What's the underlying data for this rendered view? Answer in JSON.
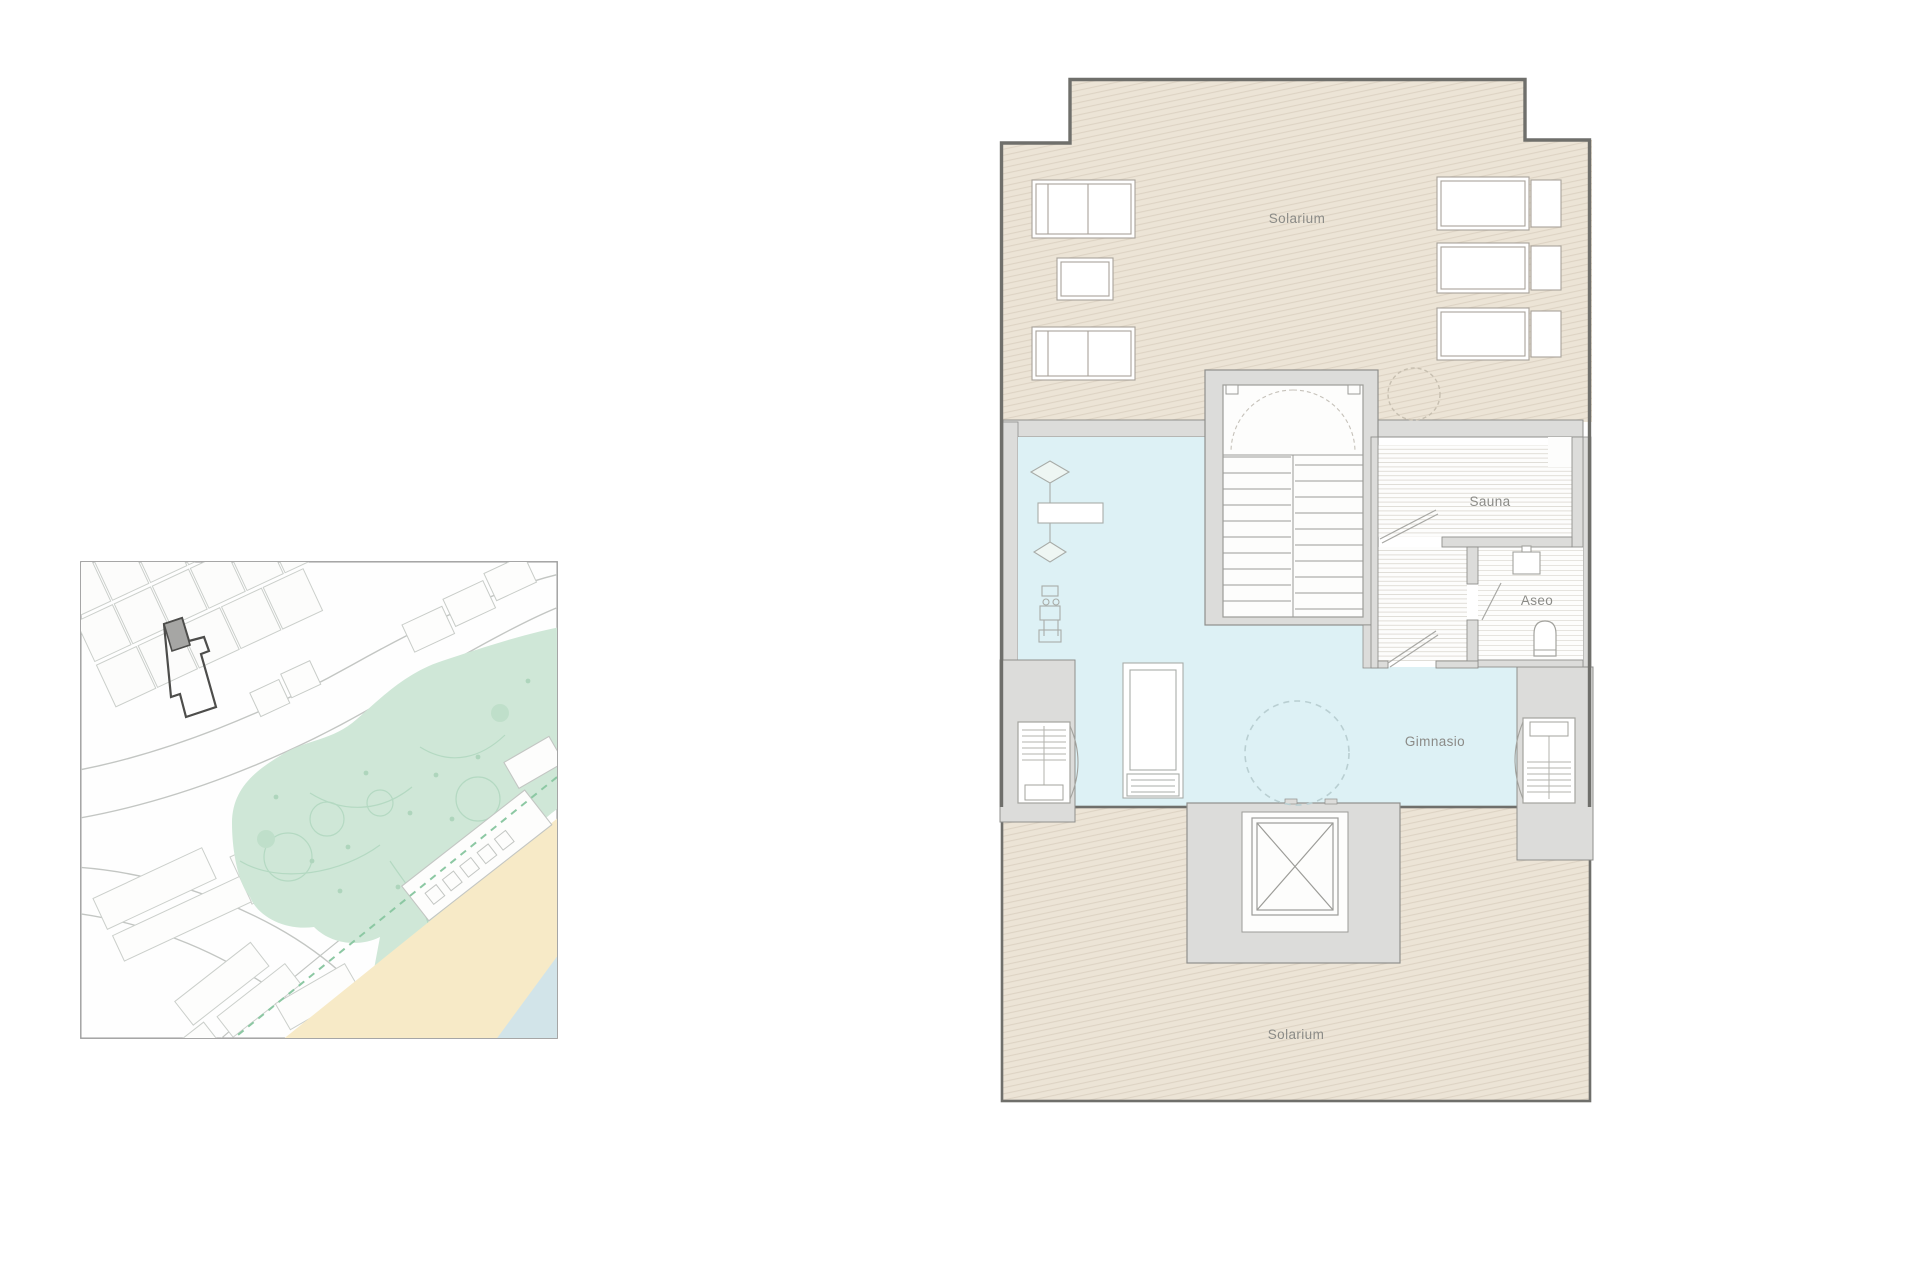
{
  "page": {
    "background": "#ffffff"
  },
  "floor_plan": {
    "rooms": {
      "solarium_top": "Solarium",
      "sauna": "Sauna",
      "aseo": "Aseo",
      "gimnasio": "Gimnasio",
      "solarium_bottom": "Solarium"
    },
    "colors": {
      "solarium_floor": "#ece4d6",
      "solarium_hatch": "#dcd2c2",
      "gym_floor": "#ddf1f5",
      "wall_fill": "#dcdcda",
      "wall_edge": "#8f8f8c",
      "outer_wall": "#6f6f6b",
      "furniture_stroke": "#a8a29a",
      "label_text": "#8b8b87"
    }
  },
  "site_map": {
    "colors": {
      "border": "#9c9c9c",
      "street": "#c3c6c3",
      "building_outline": "#cbcfcb",
      "park_fill": "#cfe7d7",
      "park_path": "#b4d9c2",
      "sand_fill": "#f7eac7",
      "water_fill": "#d2e4e9",
      "site_outline": "#4d4d4b",
      "site_building_fill": "#a6a6a4",
      "promenade_dash": "#8cc8a3"
    }
  }
}
